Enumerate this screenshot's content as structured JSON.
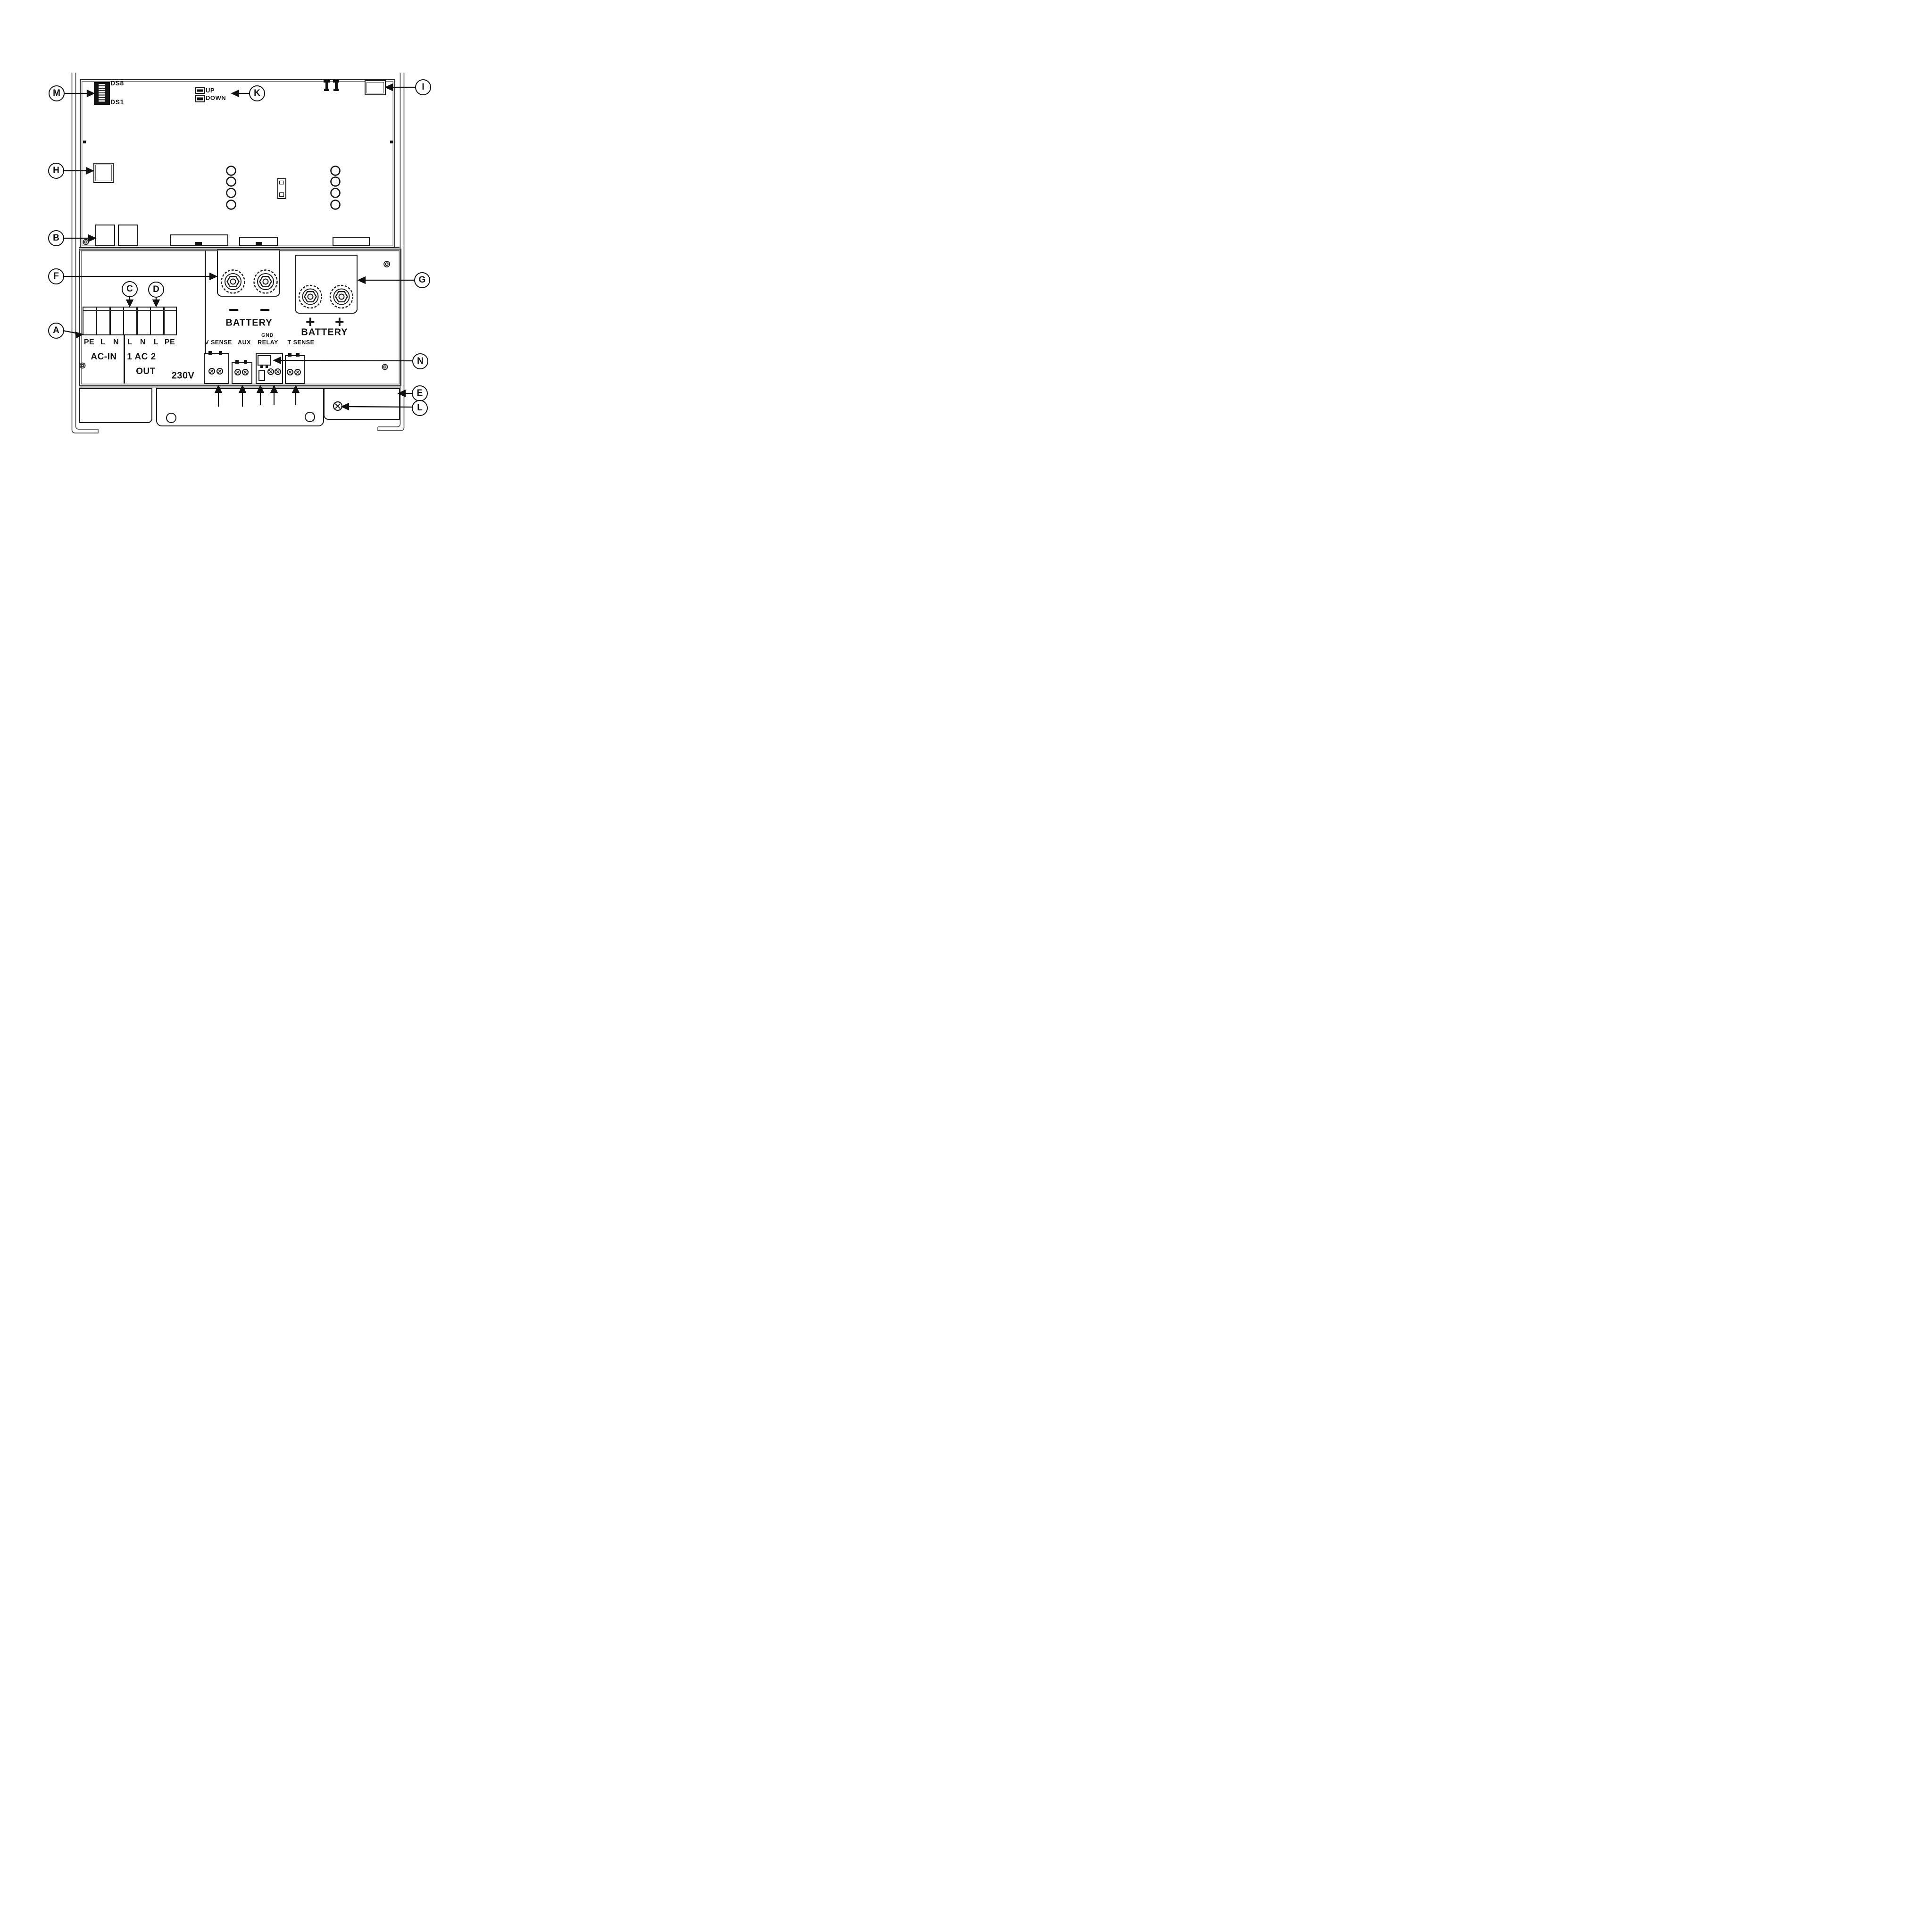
{
  "callouts": {
    "a": "A",
    "b": "B",
    "c": "C",
    "d": "D",
    "e": "E",
    "f": "F",
    "g": "G",
    "h": "H",
    "i": "I",
    "k": "K",
    "l": "L",
    "m": "M",
    "n": "N"
  },
  "dip_switch": {
    "top_label": "DS8",
    "bottom_label": "DS1"
  },
  "buttons": {
    "up": "UP",
    "down": "DOWN"
  },
  "ac_section": {
    "terminals": [
      "PE",
      "L",
      "N",
      "L",
      "N",
      "L",
      "PE"
    ],
    "in_label": "AC-IN",
    "out_label": "1 AC 2",
    "out_label2": "OUT",
    "voltage": "230V"
  },
  "battery": {
    "negative_sign": "−",
    "positive_sign": "+",
    "negative_label": "BATTERY",
    "positive_label": "BATTERY"
  },
  "signal_row": {
    "v_sense": "V SENSE",
    "aux": "AUX",
    "gnd": "GND",
    "relay": "RELAY",
    "t_sense": "T SENSE"
  }
}
